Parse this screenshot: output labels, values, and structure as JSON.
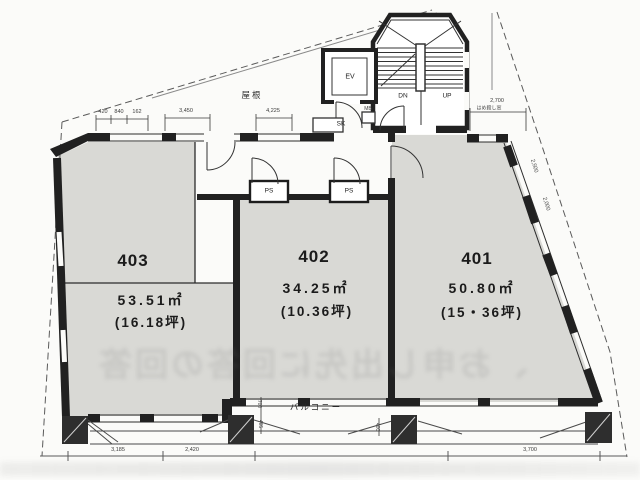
{
  "plan": {
    "rooms": [
      {
        "number": "403",
        "area": "53.51㎡",
        "tsubo": "(16.18坪)"
      },
      {
        "number": "402",
        "area": "34.25㎡",
        "tsubo": "(10.36坪)"
      },
      {
        "number": "401",
        "area": "50.80㎡",
        "tsubo": "(15・36坪)"
      }
    ],
    "core": {
      "ev": "EV",
      "dn": "DN",
      "up": "UP",
      "sk": "SK",
      "mb": "MB",
      "ps": "PS"
    },
    "balcony_label": "バルコニー",
    "roof_label": "屋根",
    "window_note": "はめ殺し窓",
    "dims": {
      "top_a": [
        "420",
        "840",
        "162"
      ],
      "top_b": "3,450",
      "top_c": "4,225",
      "right": "2,700",
      "diag": [
        "2,500",
        "2,000"
      ],
      "bottom": [
        "3,185",
        "2,420",
        "3,700"
      ],
      "small": [
        "700",
        "405",
        "400"
      ]
    },
    "watermark": "、お申し出先に回答の回答",
    "colors": {
      "floor": "#d9d9d5",
      "wall": "#212121",
      "paper": "#fbfbf9"
    }
  }
}
